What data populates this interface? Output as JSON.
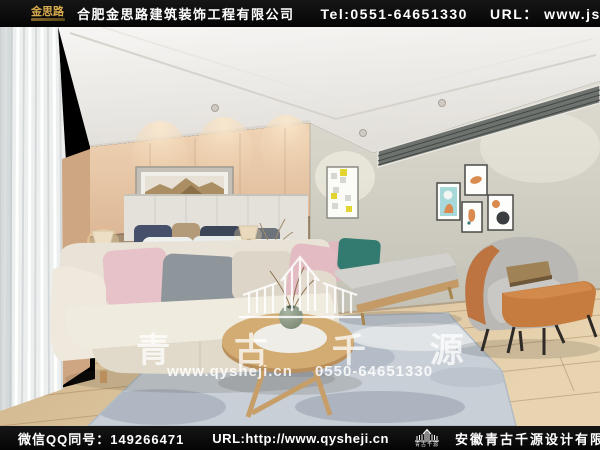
{
  "header": {
    "brand": "金思路",
    "company": "合肥金思路建筑装饰工程有限公司",
    "tel": "Tel:0551-64651330",
    "url": "URL：  www.jslu.cn"
  },
  "watermark": {
    "brand": "青 古 千 源",
    "site": "www.qysheji.cn",
    "phone": "0550-64651330"
  },
  "footer": {
    "qq": "微信QQ同号：149266471",
    "url": "URL:http://www.qysheji.cn",
    "logo_label": "青古千源",
    "company": "安徽青古千源设计有限公司"
  },
  "icons": {
    "header_logo": "gold-door-building-icon",
    "footer_logo": "white-skyline-building-icon",
    "watermark_logo": "pagoda-skyline-building-icon"
  },
  "colors": {
    "bar_background": "#0a0a0a",
    "brand_gold": "#d8ab4f",
    "headboard_wall_tan": "#dcb795",
    "right_wall_gray": "#d0cec3",
    "floor_wood": "#dcc49e",
    "rug_blue_gray": "#c8cfd6",
    "sofa_cream": "#e9e3d7",
    "pillow_pink": "#e7c3c9",
    "pillow_teal": "#337a70",
    "armchair_orange": "#c67c3e",
    "watermark_white": "rgba(255,255,255,0.8)"
  },
  "scene_description": "3D interior render: bedroom with tan headboard wall, panoramic volcano artwork, bed with navy and tan pillows, cream sofa with pink and gray cushions, gray daybed, orange-gray armchair with ottoman, round wood coffee table on blue-gray rug"
}
